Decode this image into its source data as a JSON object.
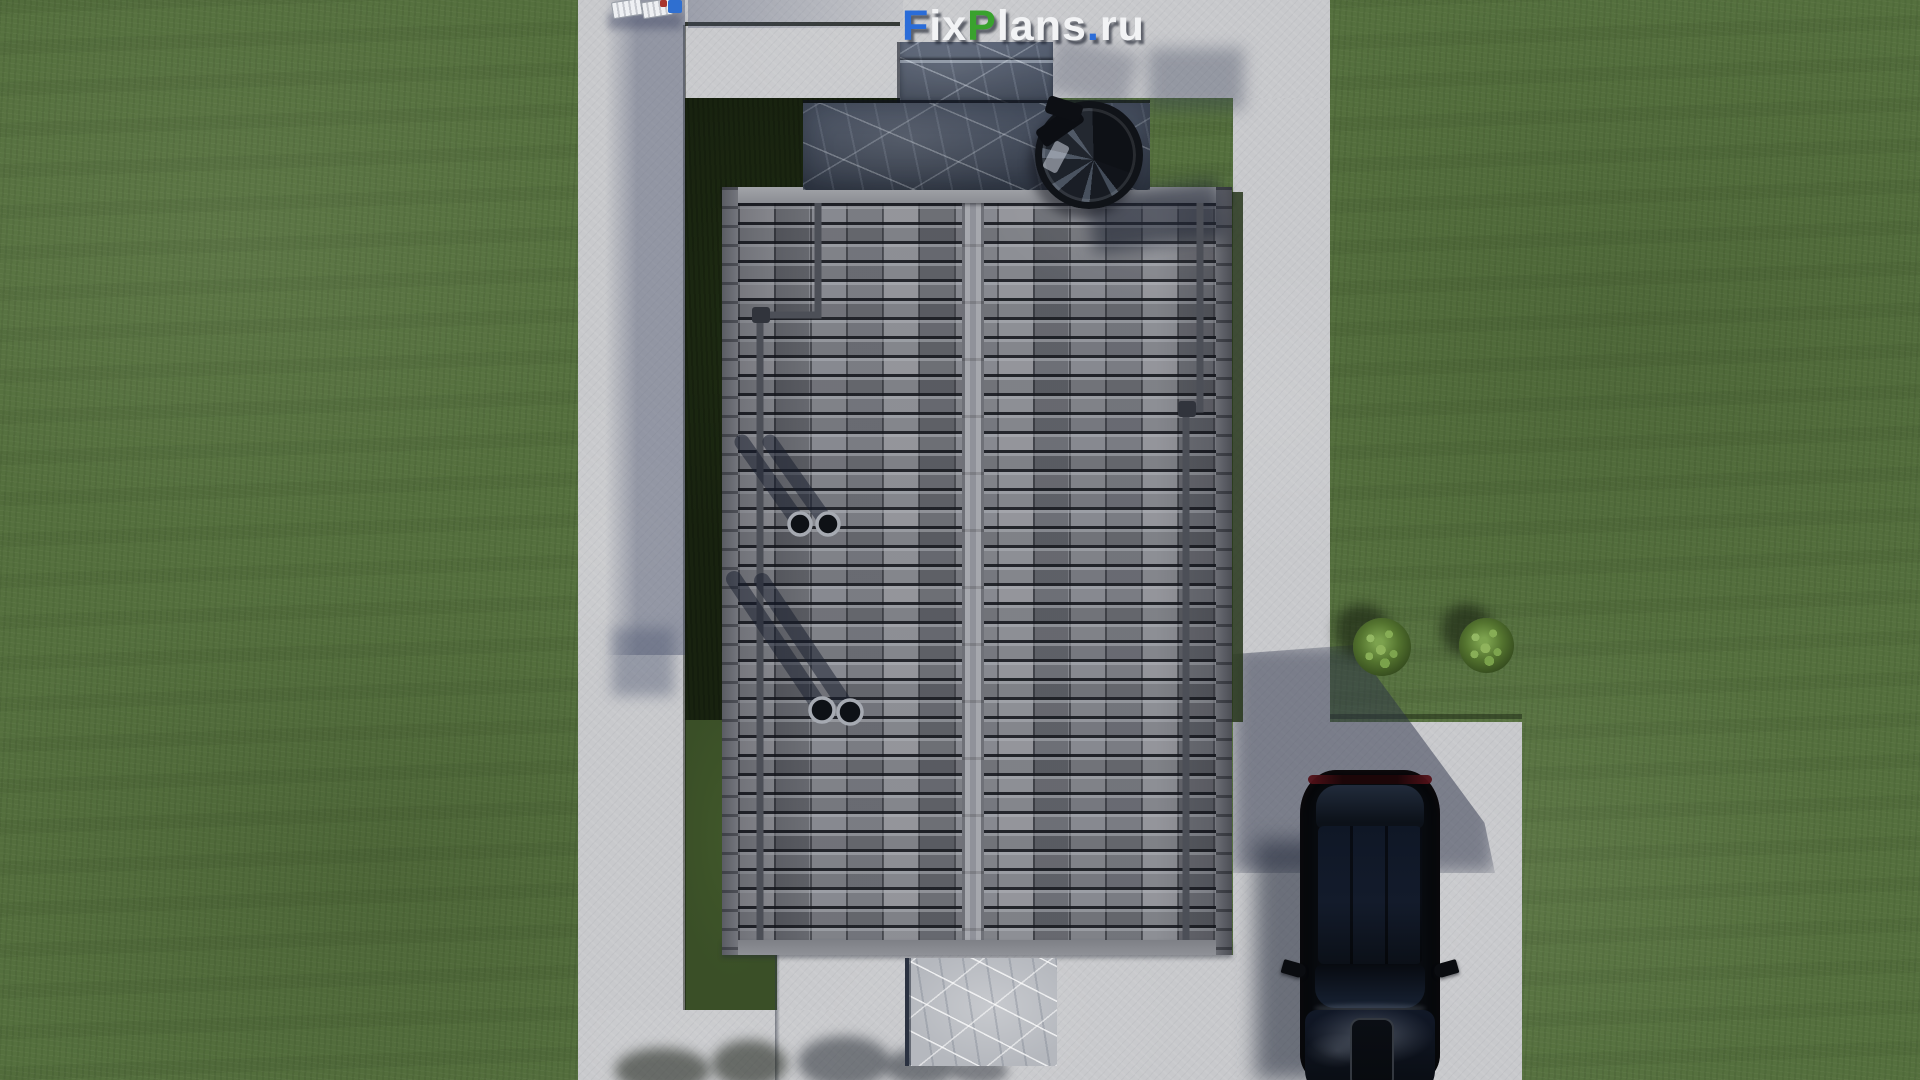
{
  "watermark": {
    "text": "FixPlans.ru",
    "parts": [
      {
        "text": "F",
        "color": "blue"
      },
      {
        "text": "ix",
        "color": "white"
      },
      {
        "text": "P",
        "color": "green"
      },
      {
        "text": "lans",
        "color": "white"
      },
      {
        "text": ".",
        "color": "blue"
      },
      {
        "text": "ru",
        "color": "white"
      }
    ]
  },
  "palette": {
    "grass": "#55703e",
    "grass-dark": "#18220f",
    "concrete": "#c8c9cc",
    "concrete-shadow": "#474f6b",
    "roof-tile": "#75777e",
    "roof-ridge": "#9a9ca2",
    "marble-dark": "#3e4654",
    "marble-light": "#b5b8be",
    "car-black": "#090c11",
    "taillight-red": "#57121a",
    "bush-green": "#54742f",
    "logo-blue": "#2a6cd8",
    "logo-green": "#39a22e",
    "logo-white": "#f2f3f5"
  },
  "scene": {
    "view": "top-down aerial render",
    "objects": [
      "lawn",
      "perimeter-walkway",
      "interior-courtyard",
      "tiled-gable-roof",
      "roof-ridge",
      "gutter-downpipes",
      "roof-vent-pipes",
      "stone-terrace",
      "spiral-staircase",
      "sun-loungers",
      "marble-doorstep",
      "driveway",
      "black-car",
      "garden-bushes",
      "tree-shadows"
    ]
  }
}
